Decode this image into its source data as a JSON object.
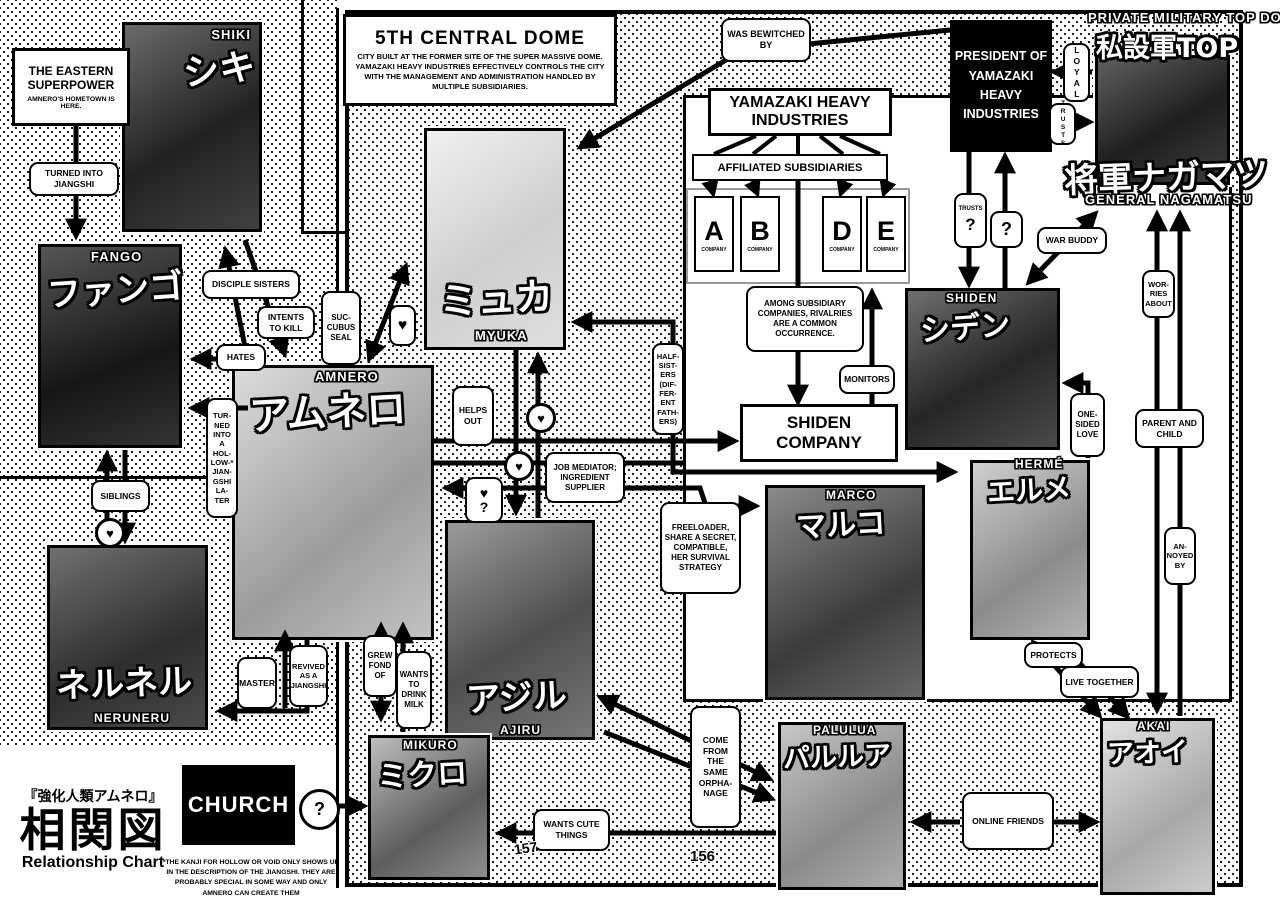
{
  "page": {
    "left_number": "157",
    "right_number": "156"
  },
  "title_block": {
    "series": "『強化人類アムネロ』",
    "chart": "相関図",
    "subtitle": "Relationship Chart"
  },
  "footnote": "*THE KANJI FOR HOLLOW OR VOID ONLY SHOWS UP IN THE DESCRIPTION OF THE JIANGSHI. THEY ARE PROBABLY SPECIAL IN SOME WAY AND ONLY AMNERO CAN CREATE THEM",
  "info": {
    "eastern": {
      "title": "THE EASTERN SUPERPOWER",
      "body": "AMNERO'S HOMETOWN IS HERE."
    },
    "dome": {
      "title": "5TH CENTRAL DOME",
      "body": "CITY BUILT AT THE FORMER SITE OF THE SUPER MASSIVE DOME. YAMAZAKI HEAVY INDUSTRIES EFFECTIVELY CONTROLS THE CITY WITH THE MANAGEMENT AND ADMINISTRATION HANDLED BY MULTIPLE SUBSIDIARIES."
    }
  },
  "org": {
    "yamazaki": "YAMAZAKI HEAVY INDUSTRIES",
    "affiliated": "AFFILIATED SUBSIDIARIES",
    "companies": [
      {
        "letter": "A",
        "sub": "COMPANY"
      },
      {
        "letter": "B",
        "sub": "COMPANY"
      },
      {
        "letter": "D",
        "sub": "COMPANY"
      },
      {
        "letter": "E",
        "sub": "COMPANY"
      }
    ],
    "rivalry": "AMONG SUBSIDIARY COMPANIES, RIVALRIES ARE A COMMON OCCURRENCE.",
    "shiden_company": "SHIDEN COMPANY",
    "president": "PRESIDENT OF YAMAZAKI HEAVY INDUSTRIES",
    "church": "CHURCH"
  },
  "characters": {
    "shiki": {
      "en": "SHIKI",
      "jp": "シキ"
    },
    "fango": {
      "en": "FANGO",
      "jp": "ファンゴ"
    },
    "myuka": {
      "en": "MYUKA",
      "jp": "ミュカ"
    },
    "amnero": {
      "en": "AMNERO",
      "jp": "アムネロ"
    },
    "neruneru": {
      "en": "NERUNERU",
      "jp": "ネルネル"
    },
    "ajiru": {
      "en": "AJIRU",
      "jp": "アジル"
    },
    "mikuro": {
      "en": "MIKURO",
      "jp": "ミクロ"
    },
    "marco": {
      "en": "MARCO",
      "jp": "マルコ"
    },
    "shiden": {
      "en": "SHIDEN",
      "jp": "シデン"
    },
    "herme": {
      "en": "HERMÉ",
      "jp": "エルメ"
    },
    "palulua": {
      "en": "PALULUA",
      "jp": "パルルア"
    },
    "akai": {
      "en": "AKAI",
      "jp": "アオイ"
    },
    "nagamatsu": {
      "top_title": "PRIVATE MILITARY TOP DOG",
      "top_jp": "私設軍TOP",
      "jp": "将軍ナガマツ",
      "en": "GENERAL NAGAMATSU"
    }
  },
  "labels": {
    "turned_jiangshi": "TURNED INTO JIANGSHI",
    "disciple_sisters": "DISCIPLE SISTERS",
    "intents_to_kill": "INTENTS TO KILL",
    "hates": "HATES",
    "succubus_seal": "SUC-CUBUS SEAL",
    "siblings": "SIBLINGS",
    "hollow_later": "TUR-NED INTO A HOL-LOW-* JIAN-GSHI LA-TER",
    "master": "MASTER",
    "revived_jiangshi": "REVIVED AS A JIANGSHI",
    "grew_fond": "GREW FOND OF",
    "drink_milk": "WANTS TO DRINK MILK",
    "helps_out": "HELPS OUT",
    "job_mediator": "JOB MEDIATOR; INGREDIENT SUPPLIER",
    "freeloader": "FREELOADER, SHARE A SECRET, COMPATIBLE, HER SURVIVAL STRATEGY",
    "half_sisters": "HALF-SIST-ERS (DIF-FER-ENT FATH-ERS)",
    "was_bewitched": "WAS BEWITCHED BY",
    "loyal": "LOYAL",
    "trusts": "TRUSTS",
    "war_buddy": "WAR BUDDY",
    "one_sided": "ONE-SIDED LOVE",
    "worries_about": "WOR-RIES ABOUT",
    "parent_child": "PARENT AND CHILD",
    "annoyed_by": "AN-NOYED BY",
    "protects": "PROTECTS",
    "live_together": "LIVE TOGETHER",
    "monitors": "MONITORS",
    "orphanage": "COME FROM THE SAME ORPHA-NAGE",
    "wants_cute": "WANTS CUTE THINGS",
    "online_friends": "ONLINE FRIENDS"
  },
  "symbols": {
    "heart": "♥",
    "question": "?"
  }
}
